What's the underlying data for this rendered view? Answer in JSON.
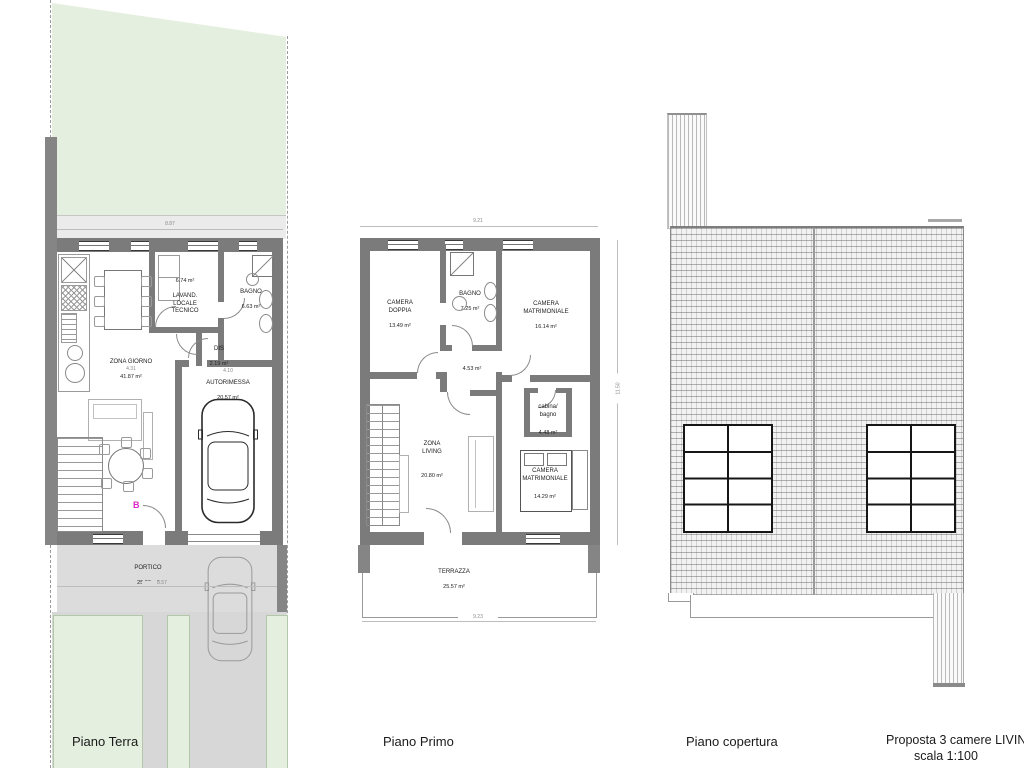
{
  "document": {
    "title": "Proposta 3 camere  LIVING I",
    "scale": "scala 1:100"
  },
  "plans": {
    "ground": {
      "caption": "Piano Terra",
      "marker": "B",
      "rooms": {
        "zona_giorno": {
          "name": "ZONA GIORNO",
          "area": "41.87 m²"
        },
        "autorimessa": {
          "name": "AUTORIMESSA",
          "area": "20.57 m²"
        },
        "lavanderia": {
          "area": "6.74 m²",
          "name": "LAVAND.\nLOCALE\nTECNICO"
        },
        "bagno": {
          "name": "BAGNO",
          "area": "6.63 m²"
        },
        "dis": {
          "name": "DIS",
          "area": "2.19 m²"
        },
        "portico": {
          "name": "PORTICO",
          "area": "25.93 m²"
        }
      },
      "dims": {
        "top_width": "8.87",
        "living_width": "4.31",
        "garage_width": "4.10",
        "portico_width": "8.57"
      }
    },
    "first": {
      "caption": "Piano Primo",
      "rooms": {
        "camera_doppia": {
          "name": "CAMERA\nDOPPIA",
          "area": "13.49 m²"
        },
        "bagno": {
          "name": "BAGNO",
          "area": "7.25 m²"
        },
        "camera_matrimoniale_1": {
          "name": "CAMERA\nMATRIMONIALE",
          "area": "16.14 m²"
        },
        "disimpegno": {
          "area": "4.53 m²"
        },
        "cabina_bagno": {
          "name": "cabina/\nbagno",
          "area": "4.48 m²"
        },
        "zona_living": {
          "name": "ZONA\nLIVING",
          "area": "20.80 m²"
        },
        "camera_matrimoniale_2": {
          "name": "CAMERA\nMATRIMONIALE",
          "area": "14.29 m²"
        },
        "terrazza": {
          "name": "TERRAZZA",
          "area": "25.57 m²"
        }
      },
      "dims": {
        "top_width": "9.21",
        "right_height": "11.50",
        "terrace_width": "9.23"
      }
    },
    "roof": {
      "caption": "Piano copertura"
    }
  }
}
